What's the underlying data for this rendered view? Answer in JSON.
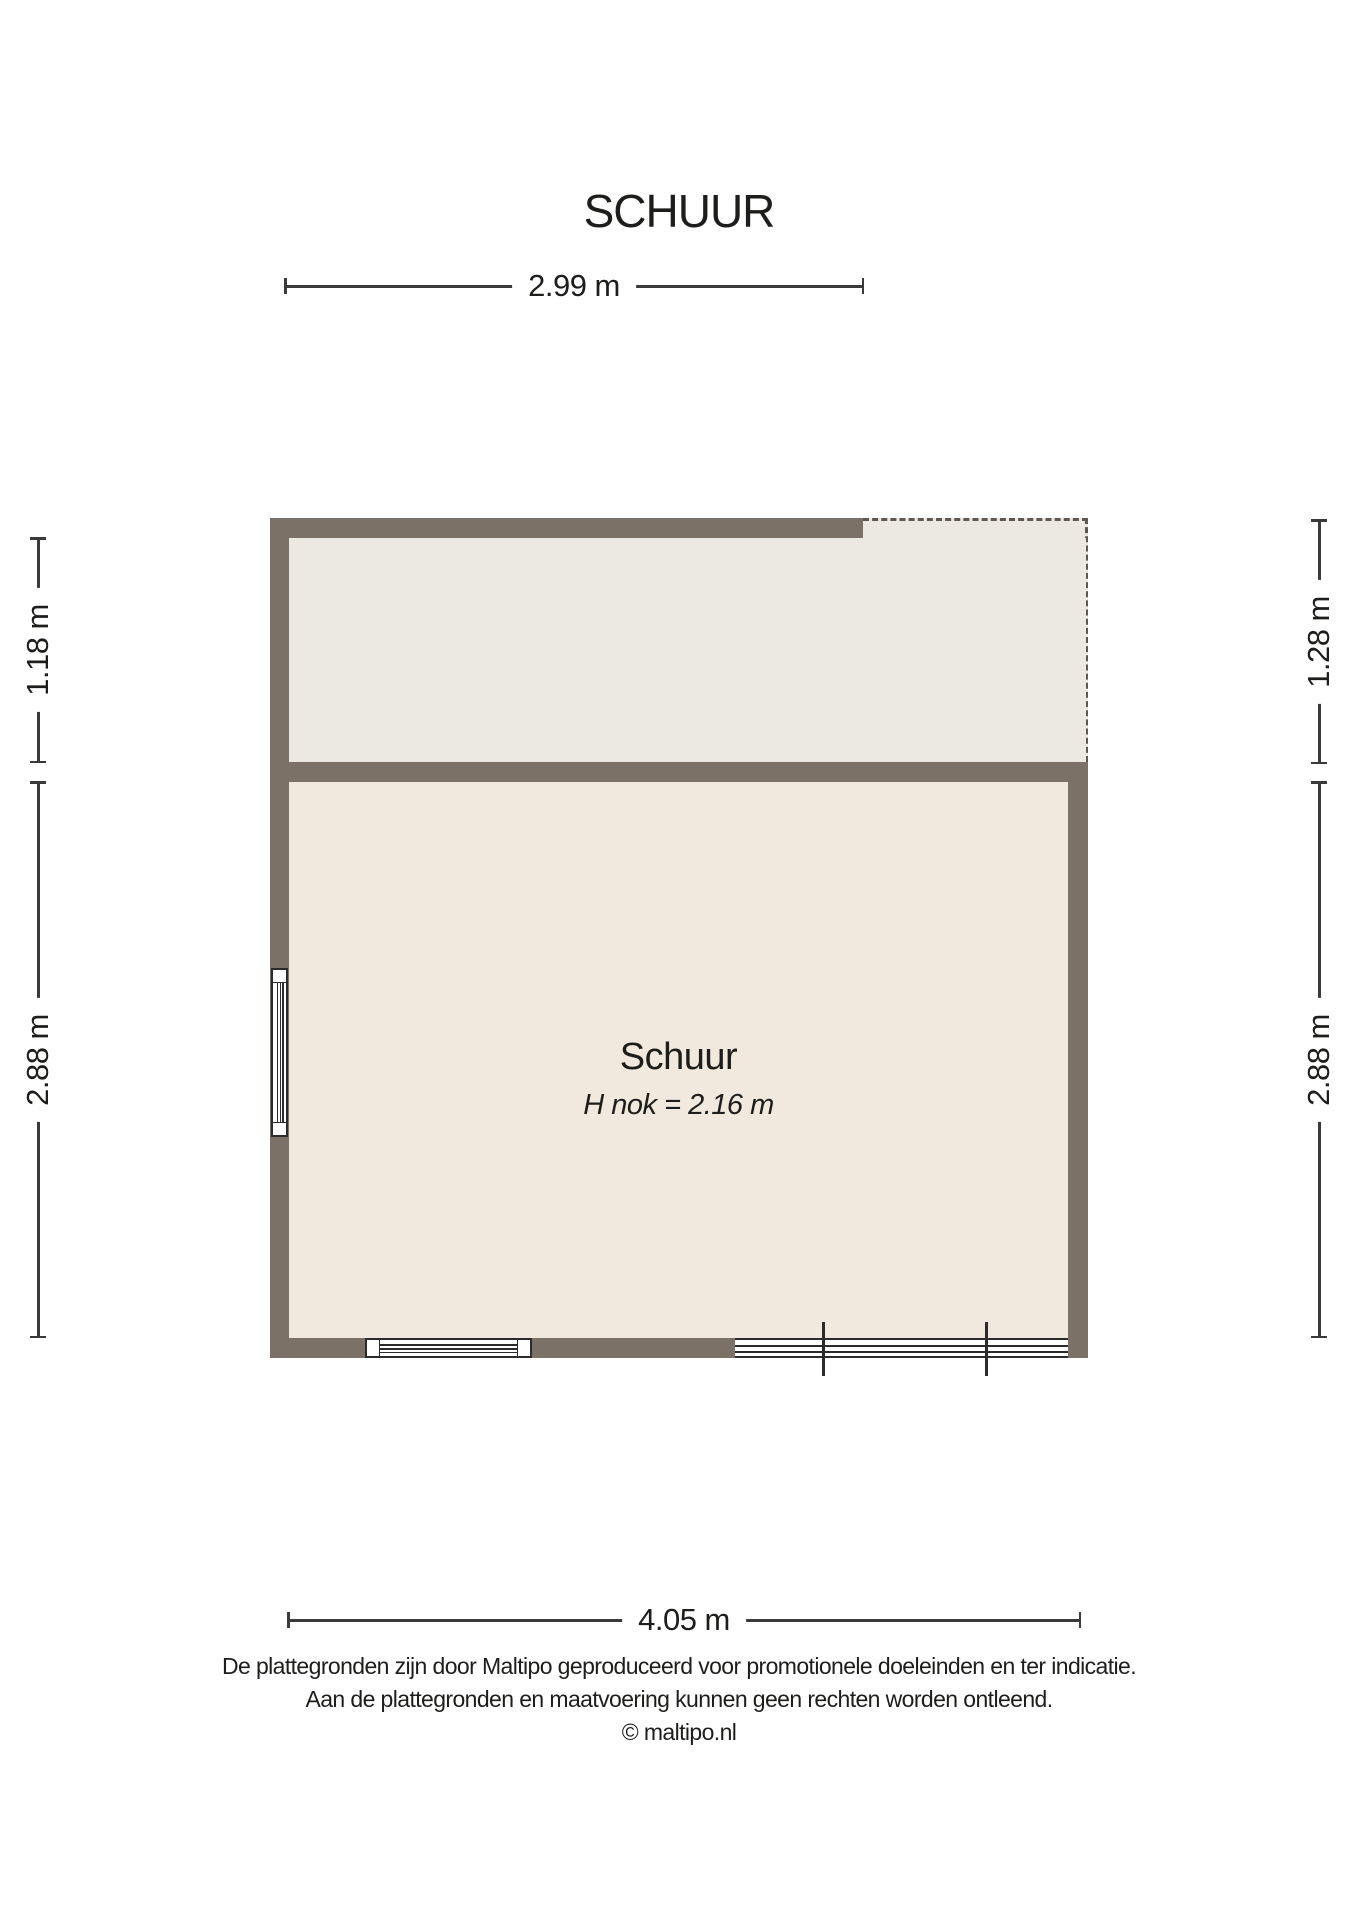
{
  "title": "SCHUUR",
  "plan": {
    "room": {
      "name": "Schuur",
      "ridge_height": "H nok = 2.16 m"
    },
    "dimensions": {
      "top_width": "2.99 m",
      "bottom_width": "4.05 m",
      "left_upper": "1.18 m",
      "left_lower": "2.88 m",
      "right_upper": "1.28 m",
      "right_lower": "2.88 m"
    }
  },
  "footer": {
    "lines": [
      "De plattegronden zijn door Maltipo geproduceerd voor promotionele doeleinden en ter indicatie.",
      "Aan de plattegronden en maatvoering kunnen geen rechten worden ontleend.",
      "© maltipo.nl"
    ]
  },
  "colors": {
    "wall": "#7c7166",
    "room_upper": "#ece9e2",
    "room_lower": "#f1e9dd",
    "dash": "#5f584e",
    "dim_line": "#3a3a3a",
    "symbol_line": "#2b2b2b",
    "text": "#1d1d1b",
    "background": "#ffffff"
  }
}
